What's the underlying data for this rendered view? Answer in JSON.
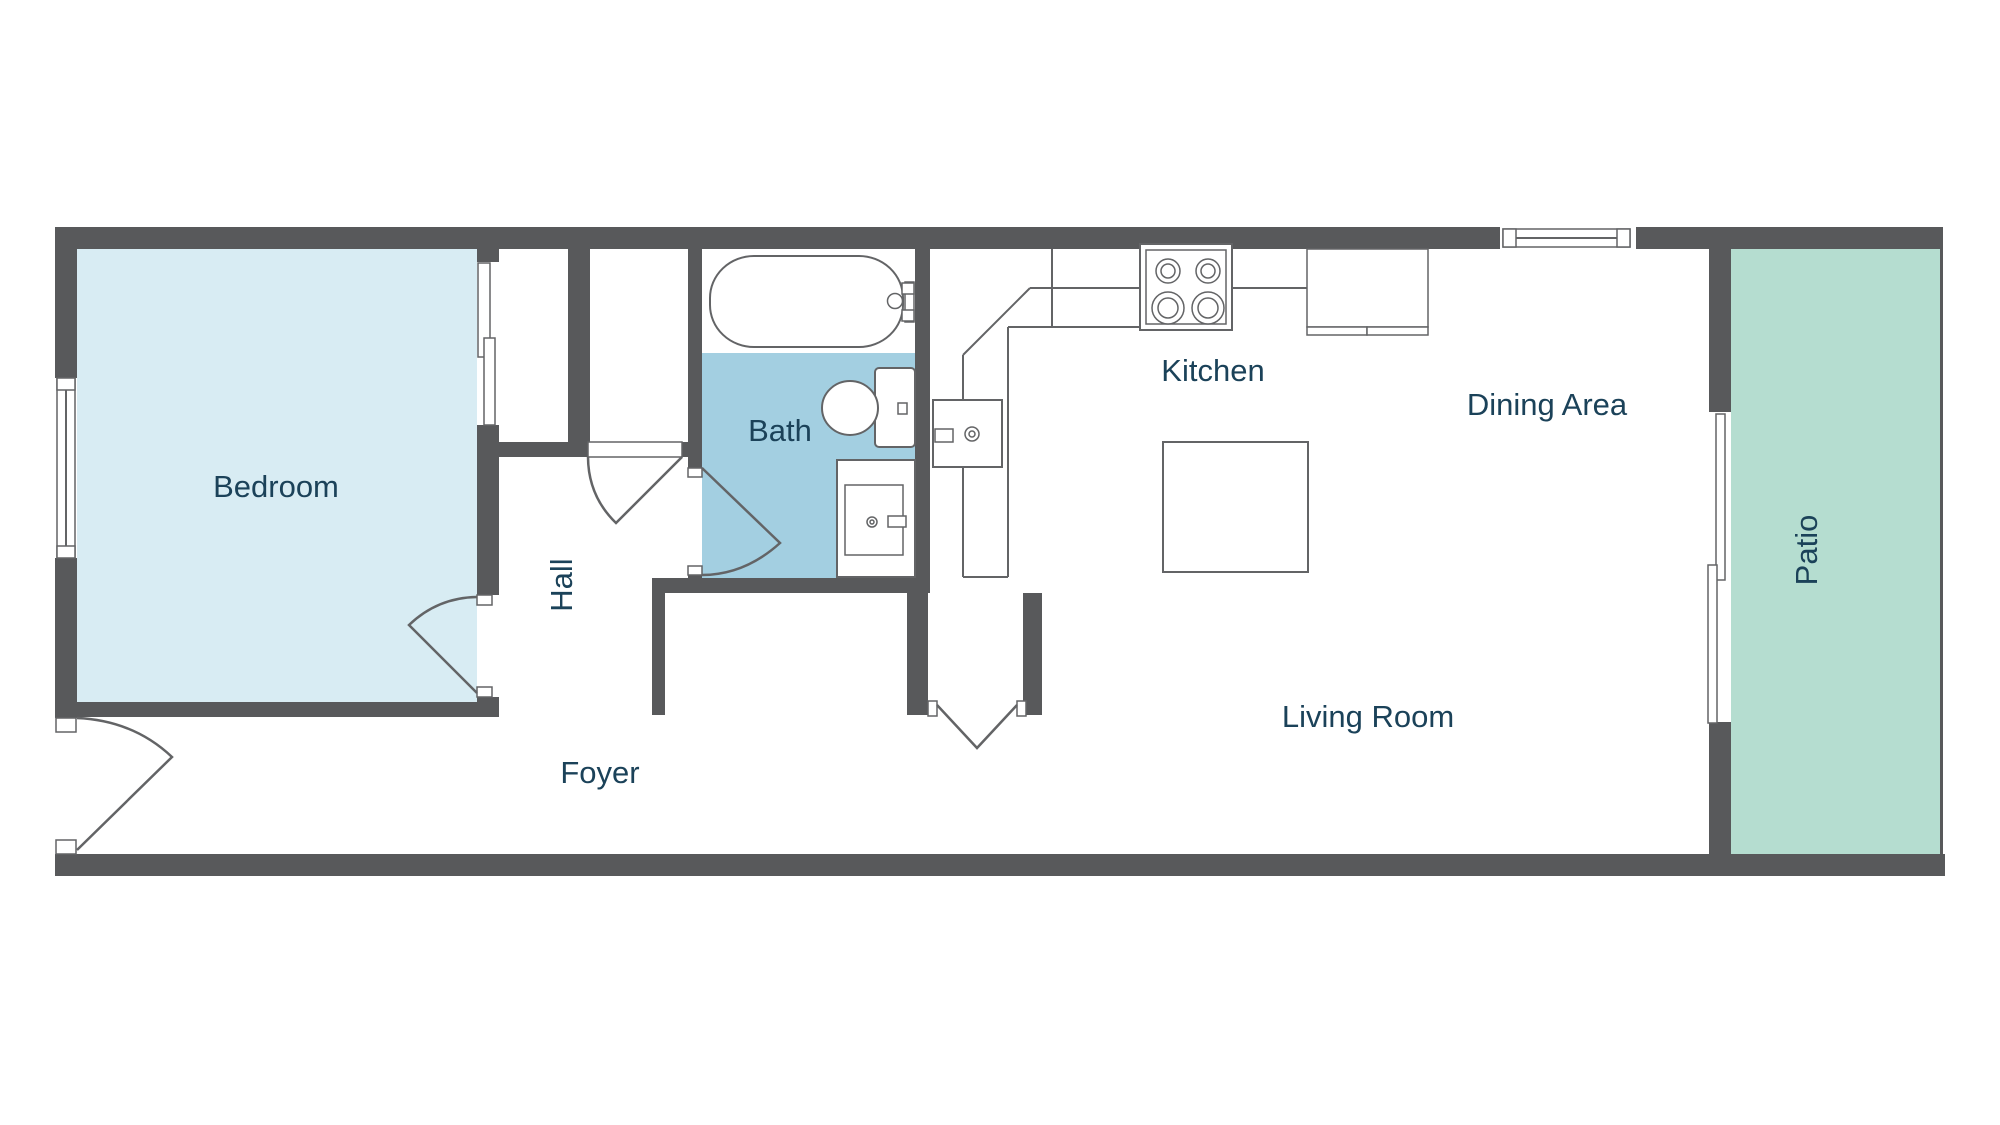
{
  "colors": {
    "wall": "#58595b",
    "line": "#636466",
    "bedroomFill": "#d8ecf3",
    "bathFill": "#a3cfe1",
    "patioFill": "#b5ddd0",
    "label": "#1b4259"
  },
  "rooms": {
    "bedroom": {
      "label": "Bedroom"
    },
    "hall": {
      "label": "Hall"
    },
    "bath": {
      "label": "Bath"
    },
    "foyer": {
      "label": "Foyer"
    },
    "kitchen": {
      "label": "Kitchen"
    },
    "dining": {
      "label": "Dining Area"
    },
    "living": {
      "label": "Living Room"
    },
    "patio": {
      "label": "Patio"
    }
  }
}
